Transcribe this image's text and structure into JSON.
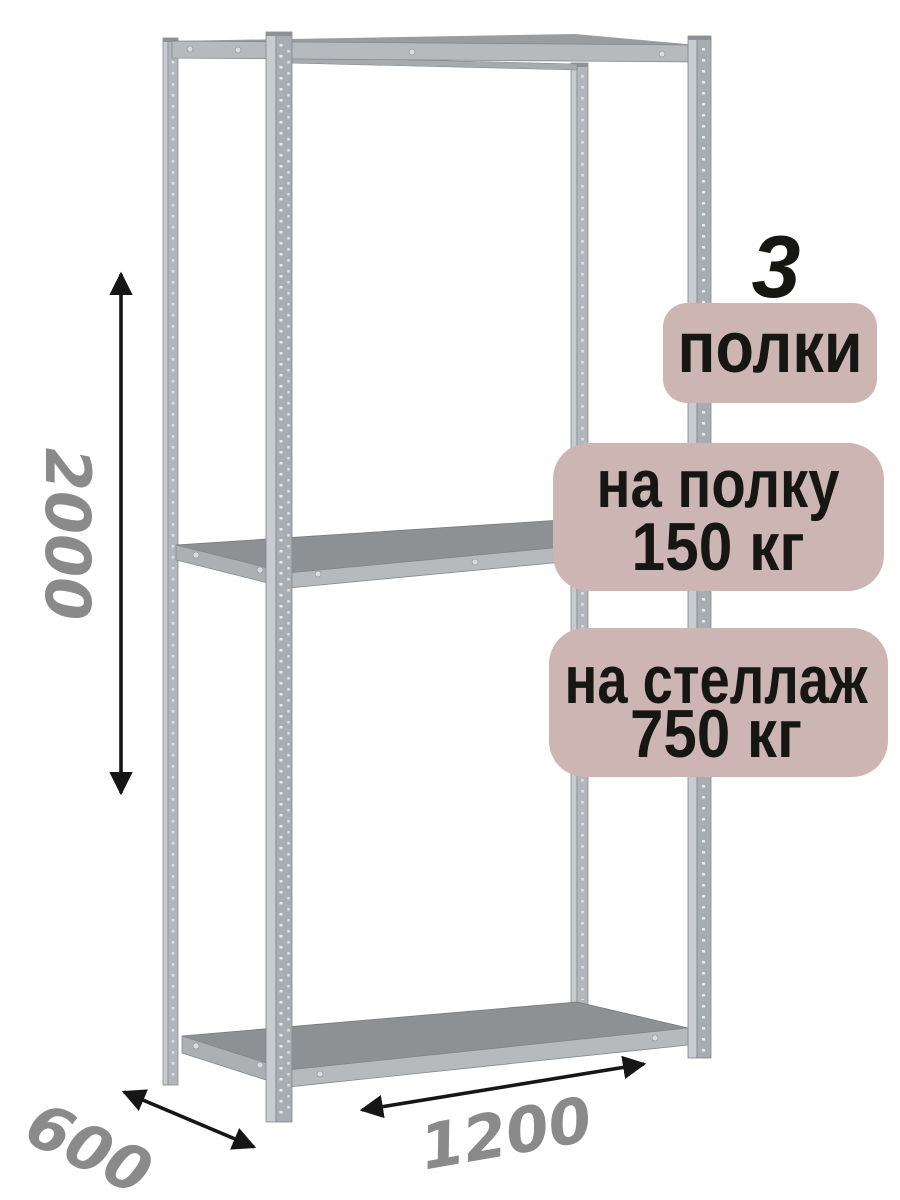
{
  "illustration": {
    "subject": "metal-shelving-rack"
  },
  "dimensions": {
    "height": "2000",
    "depth": "600",
    "width": "1200"
  },
  "callouts": {
    "shelf_count_number": "3",
    "shelf_count_label": "полки",
    "shelf_load_line1": "на полку",
    "shelf_load_line2": "150 кг",
    "rack_load_line1": "на стеллаж",
    "rack_load_line2": "750 кг"
  },
  "colors": {
    "badge_background": "#ccb5b3",
    "badge_text": "#161613",
    "dimension_number": "#8a8a8a",
    "arrow": "#161616",
    "metal_light": "#c8ccd0",
    "metal_mid": "#a8adb2",
    "metal_rear": "#b3b7bb",
    "shelf_surface": "#8e9194",
    "shelf_edge": "#b7babd"
  }
}
